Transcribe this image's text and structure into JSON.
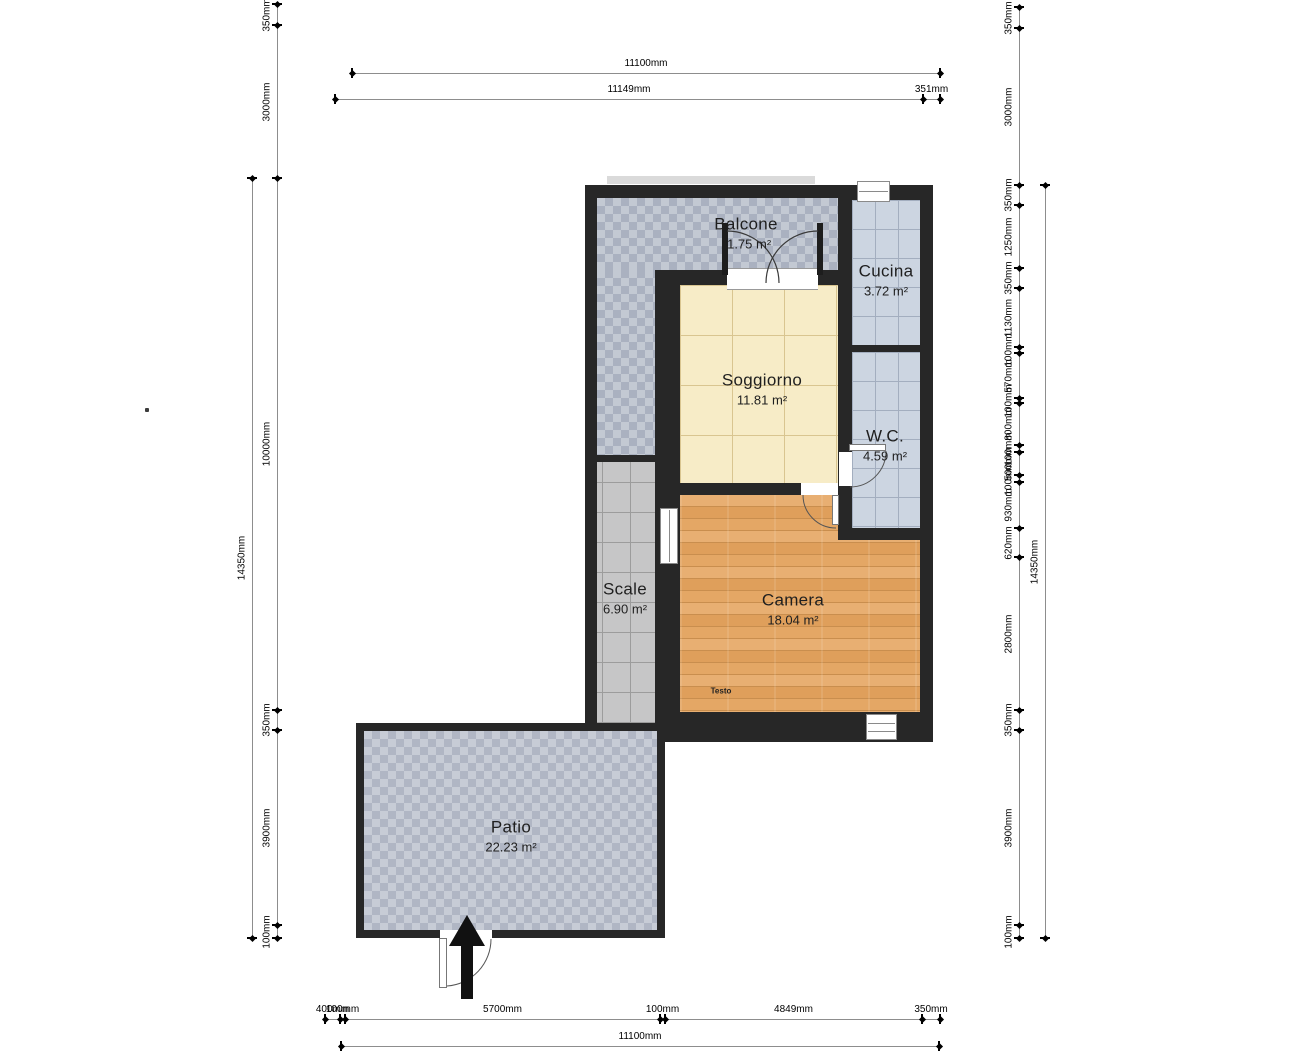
{
  "plan": {
    "rooms": [
      {
        "name": "Balcone",
        "area": "11.75 m²"
      },
      {
        "name": "Cucina",
        "area": "3.72 m²"
      },
      {
        "name": "Soggiorno",
        "area": "11.81 m²"
      },
      {
        "name": "W.C.",
        "area": "4.59 m²"
      },
      {
        "name": "Scale",
        "area": "6.90 m²"
      },
      {
        "name": "Camera",
        "area": "18.04 m²"
      },
      {
        "name": "Patio",
        "area": "22.23 m²"
      }
    ],
    "annotations": [
      {
        "text": "Testo"
      }
    ]
  },
  "colors": {
    "wall": "#272727",
    "soggiorno-floor": "#f7ecc7",
    "camera-floor": "#e0a363",
    "tile-blue-gray": "#c3c9d3",
    "grid-tile": "#ccd5e1",
    "stairs-gray": "#c6c6c7",
    "dim-line": "#8d8d8d"
  },
  "dimensions": {
    "horizontal": [
      {
        "y": 73,
        "segments": [
          {
            "label": "11100mm",
            "x1": 352,
            "x2": 940
          }
        ]
      },
      {
        "y": 99,
        "segments": [
          {
            "label": "11149mm",
            "x1": 335,
            "x2": 923
          },
          {
            "label": "351mm",
            "x1": 923,
            "x2": 940
          }
        ]
      },
      {
        "y": 1019,
        "segments": [
          {
            "label": "400mm",
            "x1": 325,
            "x2": 340
          },
          {
            "label": "100mm",
            "x1": 340,
            "x2": 345
          },
          {
            "label": "5700mm",
            "x1": 345,
            "x2": 660
          },
          {
            "label": "100mm",
            "x1": 660,
            "x2": 665
          },
          {
            "label": "4849mm",
            "x1": 665,
            "x2": 922
          },
          {
            "label": "350mm",
            "x1": 922,
            "x2": 940
          }
        ]
      },
      {
        "y": 1046,
        "segments": [
          {
            "label": "11100mm",
            "x1": 341,
            "x2": 939
          }
        ]
      }
    ],
    "vertical": [
      {
        "x": 277,
        "segments": [
          {
            "label": "350mm",
            "y1": 4,
            "y2": 25
          },
          {
            "label": "3000mm",
            "y1": 25,
            "y2": 178
          },
          {
            "label": "10000mm",
            "y1": 178,
            "y2": 710
          },
          {
            "label": "350mm",
            "y1": 710,
            "y2": 730
          },
          {
            "label": "3900mm",
            "y1": 730,
            "y2": 925
          },
          {
            "label": "100mm",
            "y1": 925,
            "y2": 938
          }
        ]
      },
      {
        "x": 252,
        "segments": [
          {
            "label": "14350mm",
            "y1": 178,
            "y2": 938
          }
        ]
      },
      {
        "x": 1019,
        "segments": [
          {
            "label": "350mm",
            "y1": 7,
            "y2": 28
          },
          {
            "label": "3000mm",
            "y1": 28,
            "y2": 185
          },
          {
            "label": "350mm",
            "y1": 185,
            "y2": 205
          },
          {
            "label": "1250mm",
            "y1": 205,
            "y2": 268
          },
          {
            "label": "350mm",
            "y1": 268,
            "y2": 288
          },
          {
            "label": "1130mm",
            "y1": 288,
            "y2": 347
          },
          {
            "label": "100mm",
            "y1": 347,
            "y2": 353
          },
          {
            "label": "570mm",
            "y1": 353,
            "y2": 398
          },
          {
            "label": "100mm",
            "y1": 398,
            "y2": 403
          },
          {
            "label": "800mm",
            "y1": 403,
            "y2": 445
          },
          {
            "label": "100mm",
            "y1": 445,
            "y2": 452
          },
          {
            "label": "500mm",
            "y1": 452,
            "y2": 475
          },
          {
            "label": "100mm",
            "y1": 475,
            "y2": 482
          },
          {
            "label": "930mm",
            "y1": 482,
            "y2": 528
          },
          {
            "label": "620mm",
            "y1": 528,
            "y2": 557
          },
          {
            "label": "2800mm",
            "y1": 557,
            "y2": 710
          },
          {
            "label": "350mm",
            "y1": 710,
            "y2": 730
          },
          {
            "label": "3900mm",
            "y1": 730,
            "y2": 925
          },
          {
            "label": "100mm",
            "y1": 925,
            "y2": 938
          }
        ]
      },
      {
        "x": 1045,
        "segments": [
          {
            "label": "14350mm",
            "y1": 185,
            "y2": 938
          }
        ]
      }
    ]
  }
}
